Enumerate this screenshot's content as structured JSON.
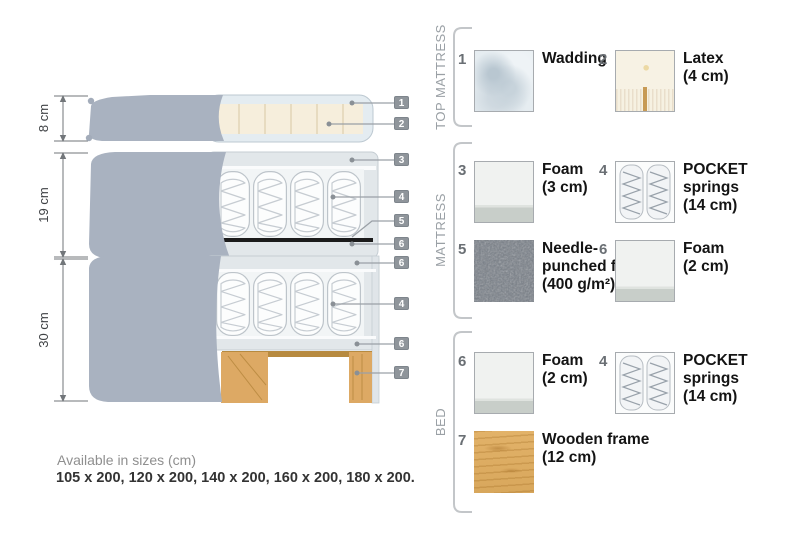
{
  "diagram": {
    "dimensions": [
      "8 cm",
      "19 cm",
      "30 cm"
    ],
    "callouts": [
      "1",
      "2",
      "3",
      "4",
      "5",
      "6",
      "6",
      "4",
      "6",
      "7"
    ]
  },
  "legend": {
    "sections": [
      {
        "title": "TOP MATTRESS",
        "items": [
          {
            "num": "1",
            "label": "Wadding",
            "size": ""
          },
          {
            "num": "2",
            "label": "Latex",
            "size": "(4 cm)"
          }
        ]
      },
      {
        "title": "MATTRESS",
        "items": [
          {
            "num": "3",
            "label": "Foam",
            "size": "(3 cm)"
          },
          {
            "num": "4",
            "label": "POCKET springs",
            "size": "(14 cm)"
          },
          {
            "num": "5",
            "label": "Needle-punched felt",
            "size": "(400 g/m²)"
          },
          {
            "num": "6",
            "label": "Foam",
            "size": "(2 cm)"
          }
        ]
      },
      {
        "title": "BED",
        "items": [
          {
            "num": "6",
            "label": "Foam",
            "size": "(2 cm)"
          },
          {
            "num": "4",
            "label": "POCKET springs",
            "size": "(14 cm)"
          },
          {
            "num": "7",
            "label": "Wooden frame",
            "size": "(12 cm)"
          }
        ]
      }
    ]
  },
  "footer": {
    "caption": "Available in sizes (cm)",
    "sizes": "105 x 200, 120 x 200, 140 x 200, 160 x 200, 180 x 200."
  },
  "colors": {
    "fabric_gray": "#a9b2c0",
    "interior_gray": "#e2e7ea",
    "latex_cream": "#f6eedc",
    "wood": "#dda964",
    "felt_dark": "#1b1b1b",
    "badge_gray": "#8f959b"
  }
}
